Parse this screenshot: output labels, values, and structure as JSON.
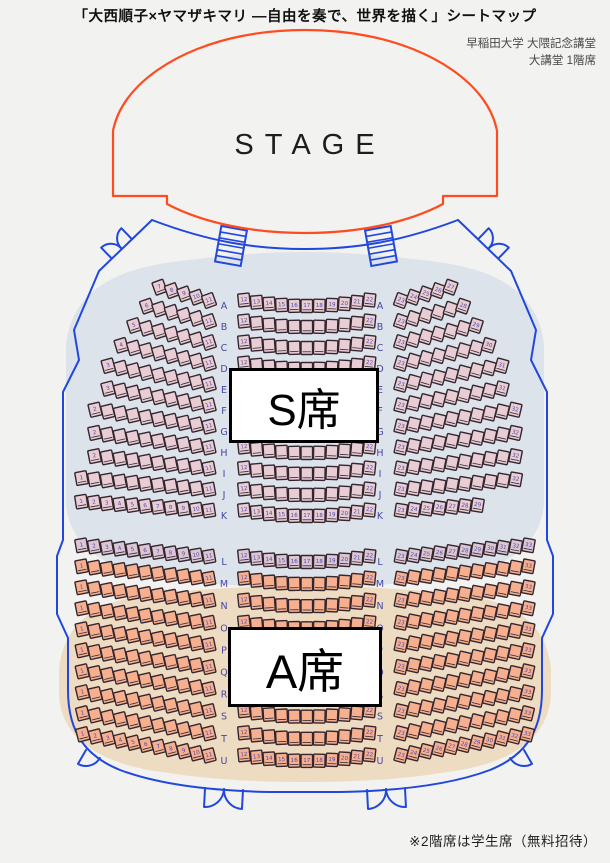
{
  "page": {
    "title": "「大西順子×ヤマザキマリ ―自由を奏で、世界を描く」シートマップ",
    "venue_line1": "早稲田大学 大隈記念講堂",
    "venue_line2": "大講堂 1階席",
    "footnote": "※2階席は学生席（無料招待）"
  },
  "stage": {
    "label": "STAGE"
  },
  "sections": {
    "s": {
      "label": "S席"
    },
    "a": {
      "label": "A席"
    }
  },
  "colors": {
    "background": "#f2f2f0",
    "stage_outline": "#ff4b1f",
    "hall_outline": "#2147dd",
    "s_zone": "#dce3ea",
    "a_zone": "#eedcc2",
    "s_seat": "#e9cdd4",
    "l_row_seat": "#ddc6d3",
    "a_seat": "#f7b08f",
    "seat_border": "#33262e",
    "row_label": "#4646a6",
    "seat_number": "#4a4aae"
  },
  "seatmap": {
    "center_range": [
      12,
      22
    ],
    "rows": [
      {
        "label": "A",
        "band": "S",
        "left_start": 7,
        "right_end": 27,
        "numbering": "full"
      },
      {
        "label": "B",
        "band": "S",
        "left_start": 6,
        "right_end": 28,
        "numbering": "ends"
      },
      {
        "label": "C",
        "band": "S",
        "left_start": 5,
        "right_end": 29,
        "numbering": "ends"
      },
      {
        "label": "D",
        "band": "S",
        "left_start": 4,
        "right_end": 30,
        "numbering": "ends"
      },
      {
        "label": "E",
        "band": "S",
        "left_start": 3,
        "right_end": 31,
        "numbering": "ends"
      },
      {
        "label": "F",
        "band": "S",
        "left_start": 3,
        "right_end": 31,
        "numbering": "ends"
      },
      {
        "label": "G",
        "band": "S",
        "left_start": 2,
        "right_end": 32,
        "numbering": "ends"
      },
      {
        "label": "H",
        "band": "S",
        "left_start": 2,
        "right_end": 32,
        "numbering": "ends"
      },
      {
        "label": "I",
        "band": "S",
        "left_start": 2,
        "right_end": 32,
        "numbering": "ends"
      },
      {
        "label": "J",
        "band": "S",
        "left_start": 1,
        "right_end": 32,
        "numbering": "ends"
      },
      {
        "label": "K",
        "band": "S",
        "left_start": 1,
        "right_end": 29,
        "numbering": "full"
      },
      {
        "label": "L",
        "band": "L",
        "left_start": 1,
        "right_end": 33,
        "numbering": "full"
      },
      {
        "label": "M",
        "band": "A",
        "left_start": 1,
        "right_end": 33,
        "numbering": "ends"
      },
      {
        "label": "N",
        "band": "A",
        "left_start": 1,
        "right_end": 33,
        "numbering": "ends"
      },
      {
        "label": "O",
        "band": "A",
        "left_start": 1,
        "right_end": 33,
        "numbering": "ends"
      },
      {
        "label": "P",
        "band": "A",
        "left_start": 1,
        "right_end": 33,
        "numbering": "ends"
      },
      {
        "label": "Q",
        "band": "A",
        "left_start": 1,
        "right_end": 33,
        "numbering": "ends"
      },
      {
        "label": "R",
        "band": "A",
        "left_start": 1,
        "right_end": 33,
        "numbering": "ends"
      },
      {
        "label": "S",
        "band": "A",
        "left_start": 1,
        "right_end": 33,
        "numbering": "ends"
      },
      {
        "label": "T",
        "band": "A",
        "left_start": 1,
        "right_end": 33,
        "numbering": "ends"
      },
      {
        "label": "U",
        "band": "A",
        "left_start": 1,
        "right_end": 33,
        "numbering": "full"
      }
    ]
  }
}
